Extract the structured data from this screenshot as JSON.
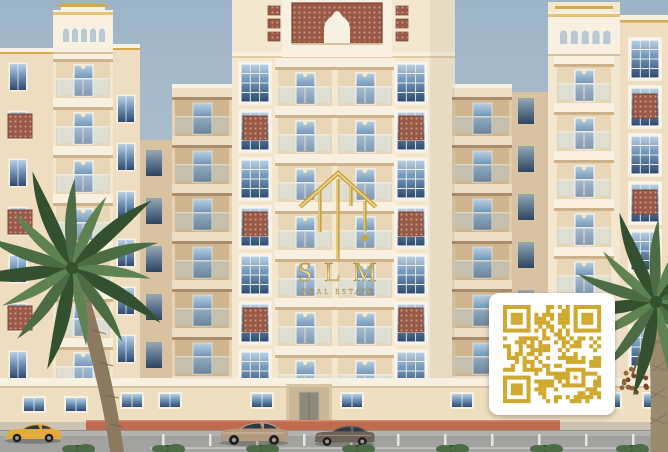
{
  "watermark": {
    "title": "SLM",
    "subtitle": "REAL ESTATE",
    "icon": "gold-house-monogram-icon",
    "color": "#c9a43c"
  },
  "qr": {
    "seed": 73,
    "modules": 25,
    "color": "#cfa92e",
    "background": "#ffffff"
  },
  "building": {
    "floors_visible": 7,
    "facade_color": "#f4e7d0",
    "accent_panel_color": "#9a5947"
  },
  "cars": [
    {
      "name": "yellow-coupe",
      "color": "#e3ab3e"
    },
    {
      "name": "beige-sedan",
      "color": "#b49a7d"
    },
    {
      "name": "brown-sedan",
      "color": "#6f6257"
    }
  ],
  "colors": {
    "sky-top": "#9db4c7",
    "sky-bot": "#c8d2d8",
    "sky-arch": "#b9c9d4",
    "cream": "#f4e7d0",
    "cream-2": "#eeddc0",
    "trim": "#f8f1e1",
    "slab-sh": "#cdb28c",
    "shadow": "#d9c2a2",
    "shadow-2": "#cfb691",
    "balc-in": "#e8d6b6",
    "win-hi": "#b9d0e2",
    "win-mid": "#6f94b8",
    "win-lo": "#2d4a6e",
    "lattice": "#9a5947",
    "lattice-dot": "#c49684",
    "gold": "#d9a84e",
    "gold-2": "#e6c276",
    "logo-gold": "#c9a43c",
    "qr": "#cfa92e",
    "road": "#a2a2a0",
    "road-2": "#b2b2b0",
    "sidewalk": "#cbc2b2",
    "apron": "#c06a50",
    "line": "#f2f2ef",
    "palm-dark": "#33512f",
    "palm-mid": "#4b6c45",
    "palm-light": "#5f8253",
    "trunk": "#8b7a5f",
    "trunk-2": "#9a8a6e",
    "dates": "#7a4a28"
  }
}
